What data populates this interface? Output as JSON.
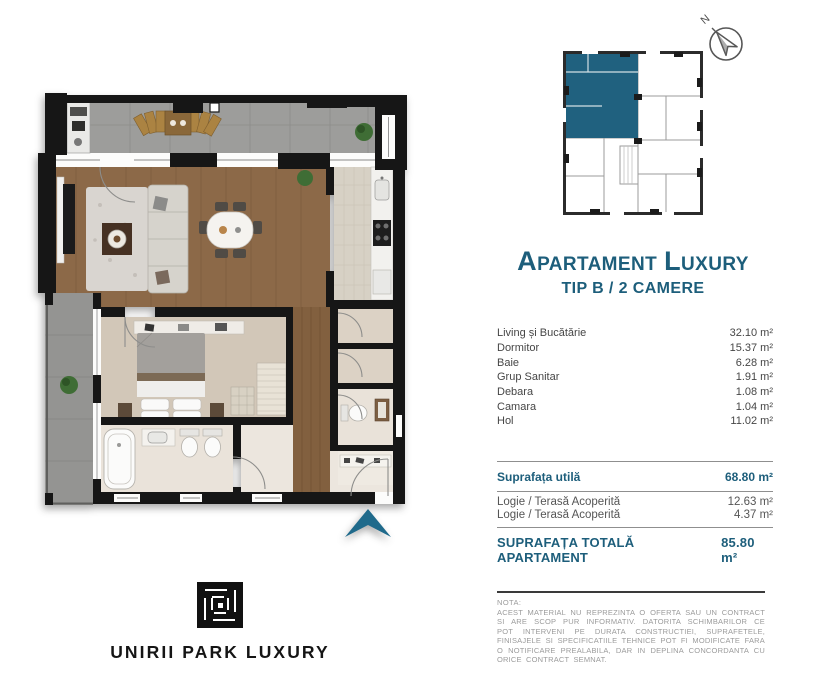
{
  "title": {
    "cap1": "A",
    "rest1": "PARTAMENT",
    "cap2": "L",
    "rest2": "UXURY",
    "subtitle": "TIP B / 2 CAMERE"
  },
  "compass": {
    "label": "N"
  },
  "rooms": {
    "items": [
      {
        "label": "Living și Bucătărie",
        "value": "32.10 m²"
      },
      {
        "label": "Dormitor",
        "value": "15.37 m²"
      },
      {
        "label": "Baie",
        "value": "6.28 m²"
      },
      {
        "label": "Grup Sanitar",
        "value": "1.91 m²"
      },
      {
        "label": "Debara",
        "value": "1.08 m²"
      },
      {
        "label": "Camara",
        "value": "1.04 m²"
      },
      {
        "label": "Hol",
        "value": "11.02 m²"
      }
    ]
  },
  "totals": {
    "usable": {
      "label": "Suprafața utilă",
      "value": "68.80 m²"
    },
    "loggia": [
      {
        "label": "Logie / Terasă Acoperită",
        "value": "12.63 m²"
      },
      {
        "label": "Logie / Terasă Acoperită",
        "value": "4.37 m²"
      }
    ],
    "total": {
      "label": "SUPRAFAȚA TOTALĂ APARTAMENT",
      "value": "85.80 m²"
    }
  },
  "note": {
    "heading": "NOTA:",
    "body": "ACEST MATERIAL NU REPREZINTA O OFERTA SAU UN CONTRACT SI ARE SCOP PUR INFORMATIV. DATORITA SCHIMBARILOR CE POT INTERVENI PE DURATA CONSTRUCTIEI, SUPRAFETELE, FINISAJELE SI SPECIFICATIILE TEHNICE POT FI MODIFICATE FARA O NOTIFICARE PREALABILA, DAR IN DEPLINA CONCORDANTA CU ORICE CONTRACT SEMNAT."
  },
  "logo": {
    "text": "UNIRII PARK LUXURY"
  },
  "icons": {
    "north_compass": "compass-arrow-pointing-north",
    "entrance_arrow": "chevron-up-entrance-marker",
    "logo_mark": "greek-key-square"
  },
  "colors": {
    "accent": "#1d5e7b",
    "accent_strong": "#1f6a8b",
    "highlight": "#20617f",
    "wall": "#161616",
    "wood": "#8c6948",
    "terrace": "#9d9d9b",
    "note_line": "#3a3a3a"
  }
}
